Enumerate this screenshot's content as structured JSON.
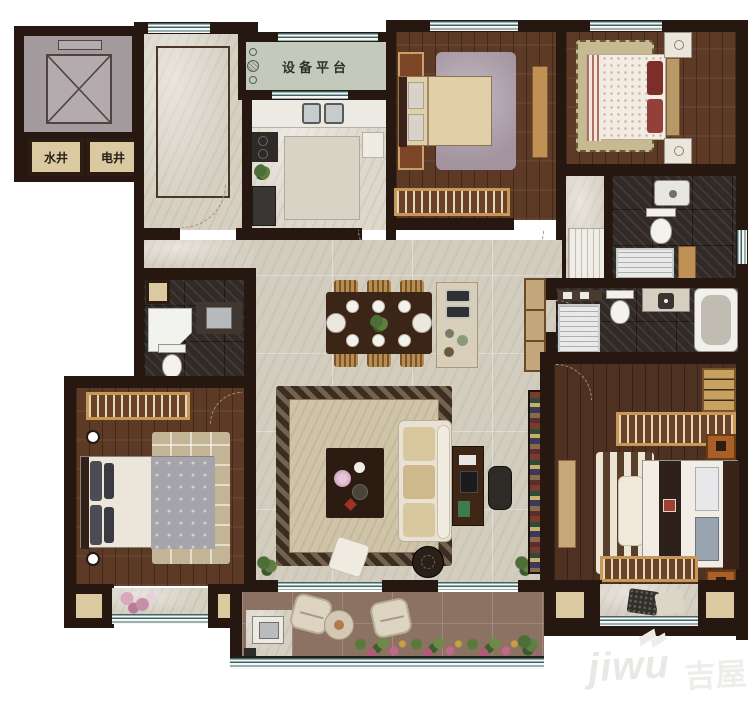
{
  "floor_plan": {
    "labels": {
      "water_shaft": "水井",
      "electric_shaft": "电井",
      "equipment_platform": "设备平台"
    },
    "watermark": {
      "latin": "jiwu",
      "cn": "吉屋"
    },
    "colors": {
      "wall": "#261711",
      "marble_floor": "#d6d0c3",
      "wood_floor": "#5c3a25",
      "dark_tile_floor": "#322a26",
      "balcony_floor": "#8c7263",
      "equipment_platform_floor": "#c3cabc",
      "window_line": "#3f6565",
      "shaft_fill": "#dbc9a2",
      "living_rug": "#cfc4a8",
      "bed_linen": "#ece6da",
      "accent_wood": "#c89858"
    }
  }
}
